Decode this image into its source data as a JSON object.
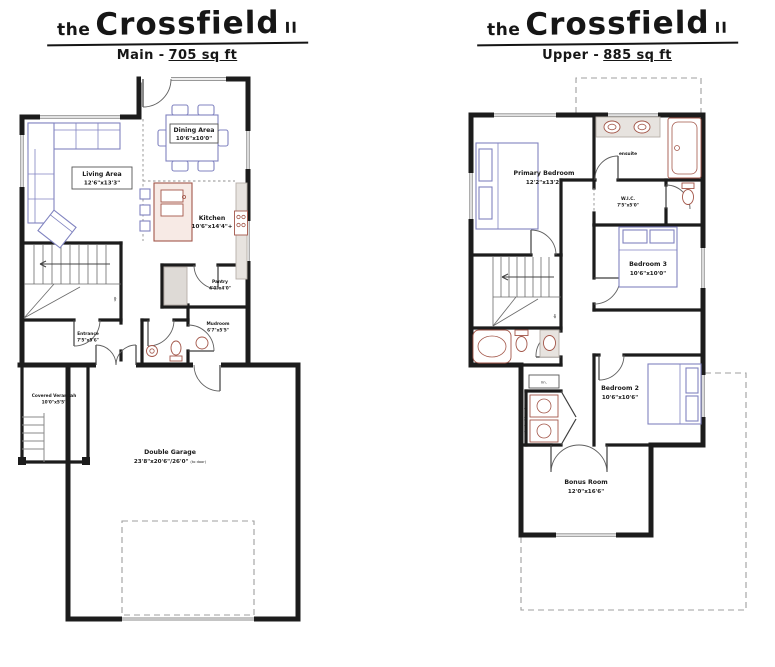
{
  "plans": {
    "main": {
      "title": {
        "pre": "the",
        "name": "Crossfield",
        "suf": "II"
      },
      "subtitle": {
        "label": "Main -",
        "value": "705 sq ft"
      },
      "rooms": {
        "living": {
          "name": "Living Area",
          "dims": "12'6\"x13'3\""
        },
        "dining": {
          "name": "Dining Area",
          "dims": "10'6\"x10'0\""
        },
        "kitchen": {
          "name": "Kitchen",
          "dims": "10'6\"x14'4\"+"
        },
        "pantry": {
          "name": "Pantry",
          "dims": "4'0\"x4'0\""
        },
        "mudroom": {
          "name": "Mudroom",
          "dims": "6'7\"x5'5\""
        },
        "entrance": {
          "name": "Entrance",
          "dims": "7'5\"x5'6\""
        },
        "verandah": {
          "name": "Covered Verandah",
          "dims": "10'0\"x5'5\""
        },
        "garage": {
          "name": "Double Garage",
          "dims": "23'8\"x20'6\"/26'0\"",
          "note": "(to door)"
        },
        "stair_note": "up"
      }
    },
    "upper": {
      "title": {
        "pre": "the",
        "name": "Crossfield",
        "suf": "II"
      },
      "subtitle": {
        "label": "Upper -",
        "value": "885 sq ft"
      },
      "rooms": {
        "primary": {
          "name": "Primary Bedroom",
          "dims": "12'2\"x13'2\""
        },
        "ensuite": {
          "name": "ensuite"
        },
        "wic": {
          "name": "W.I.C.",
          "dims": "7'5\"x5'0\""
        },
        "bedroom3": {
          "name": "Bedroom 3",
          "dims": "10'6\"x10'0\""
        },
        "bedroom2": {
          "name": "Bedroom 2",
          "dims": "10'6\"x10'6\""
        },
        "bonus": {
          "name": "Bonus Room",
          "dims": "12'0\"x16'6\""
        },
        "laundry": {
          "name": "stacked laundry"
        },
        "linen": {
          "name": "lin."
        },
        "stair_note": "dn"
      }
    }
  },
  "colors": {
    "wall": "#1c1c1c",
    "furniture_blue": "#8083c0",
    "fixture_red": "#a3574a",
    "counter_gray": "#e7e3df"
  }
}
